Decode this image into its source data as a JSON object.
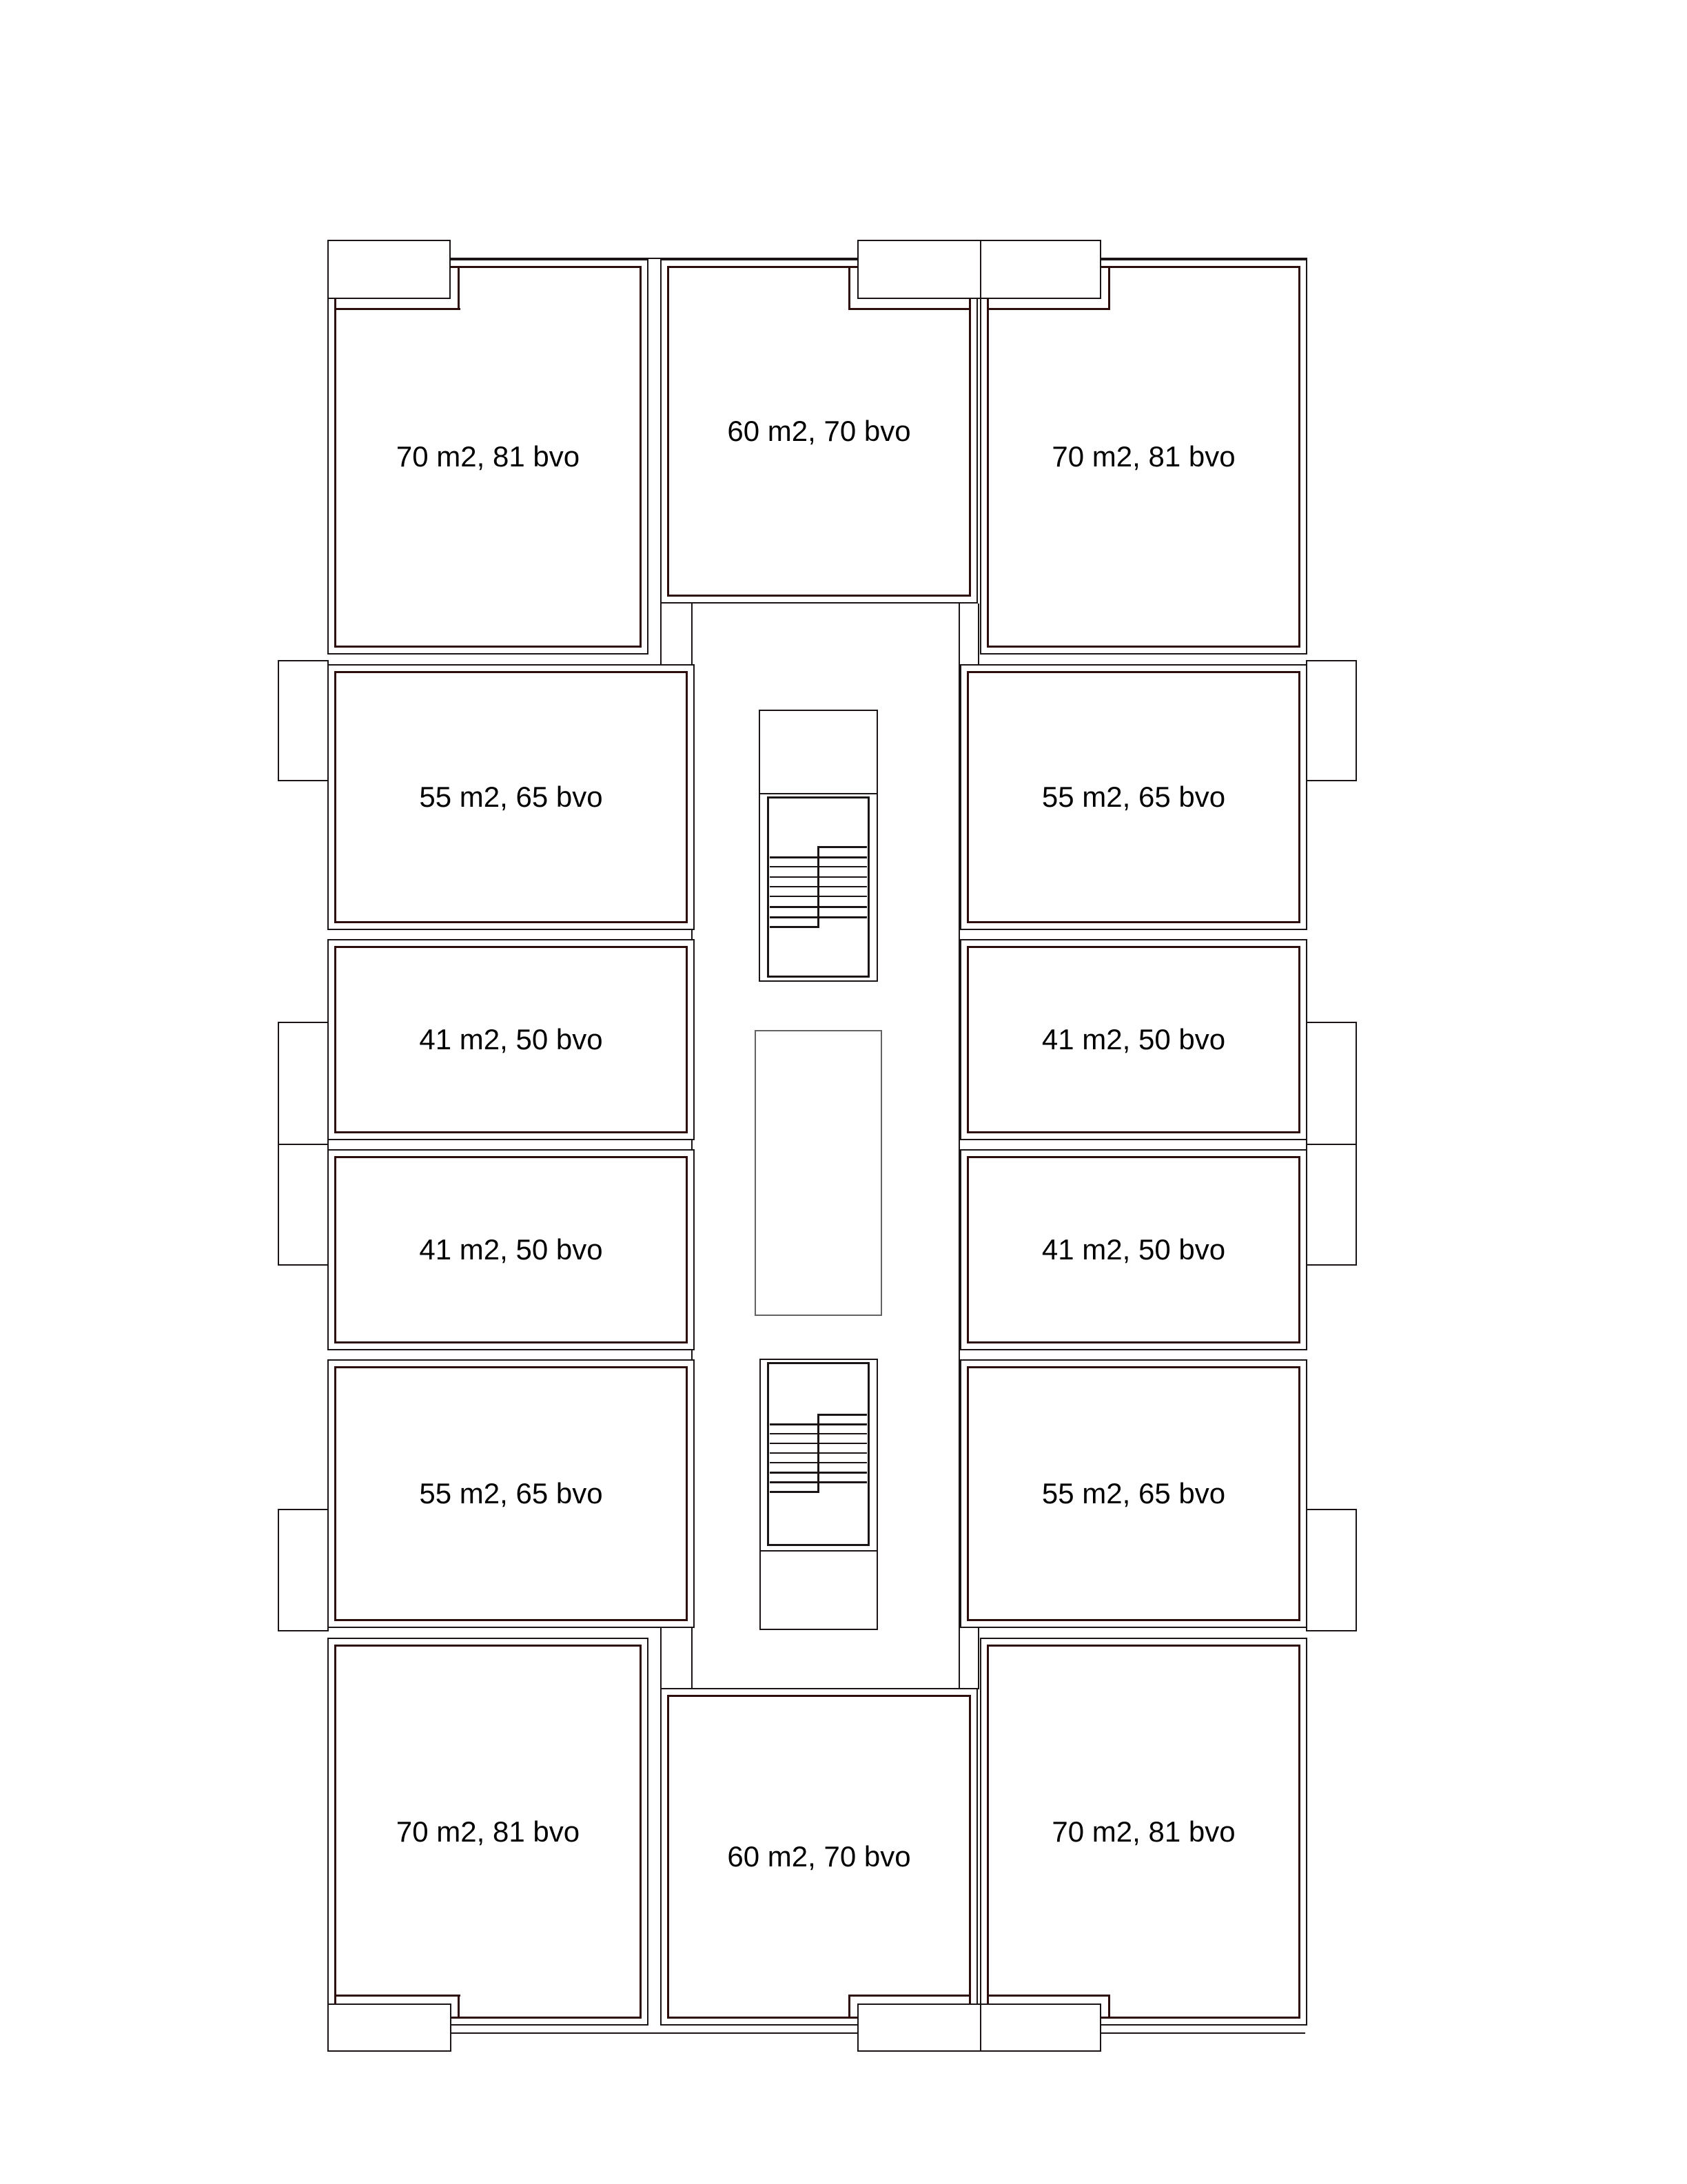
{
  "plan_name": "apartment-floor-plan",
  "units": [
    {
      "id": "top-left-70",
      "label": "70 m2, 81 bvo"
    },
    {
      "id": "top-middle-60",
      "label": "60 m2, 70 bvo"
    },
    {
      "id": "top-right-70",
      "label": "70 m2, 81 bvo"
    },
    {
      "id": "mid-left-55-upper",
      "label": "55 m2, 65 bvo"
    },
    {
      "id": "mid-right-55-upper",
      "label": "55 m2, 65 bvo"
    },
    {
      "id": "mid-left-41-upper",
      "label": "41 m2, 50 bvo"
    },
    {
      "id": "mid-right-41-upper",
      "label": "41 m2, 50 bvo"
    },
    {
      "id": "mid-left-41-lower",
      "label": "41 m2, 50 bvo"
    },
    {
      "id": "mid-right-41-lower",
      "label": "41 m2, 50 bvo"
    },
    {
      "id": "mid-left-55-lower",
      "label": "55 m2, 65 bvo"
    },
    {
      "id": "mid-right-55-lower",
      "label": "55 m2, 65 bvo"
    },
    {
      "id": "bottom-left-70",
      "label": "70 m2, 81 bvo"
    },
    {
      "id": "bottom-middle-60",
      "label": "60 m2, 70 bvo"
    },
    {
      "id": "bottom-right-70",
      "label": "70 m2, 81 bvo"
    }
  ],
  "colors": {
    "wall": "#1a1414",
    "maroon": "#2f0c0c",
    "shaft": "#636363",
    "ink": "#000000",
    "bg": "#ffffff"
  }
}
